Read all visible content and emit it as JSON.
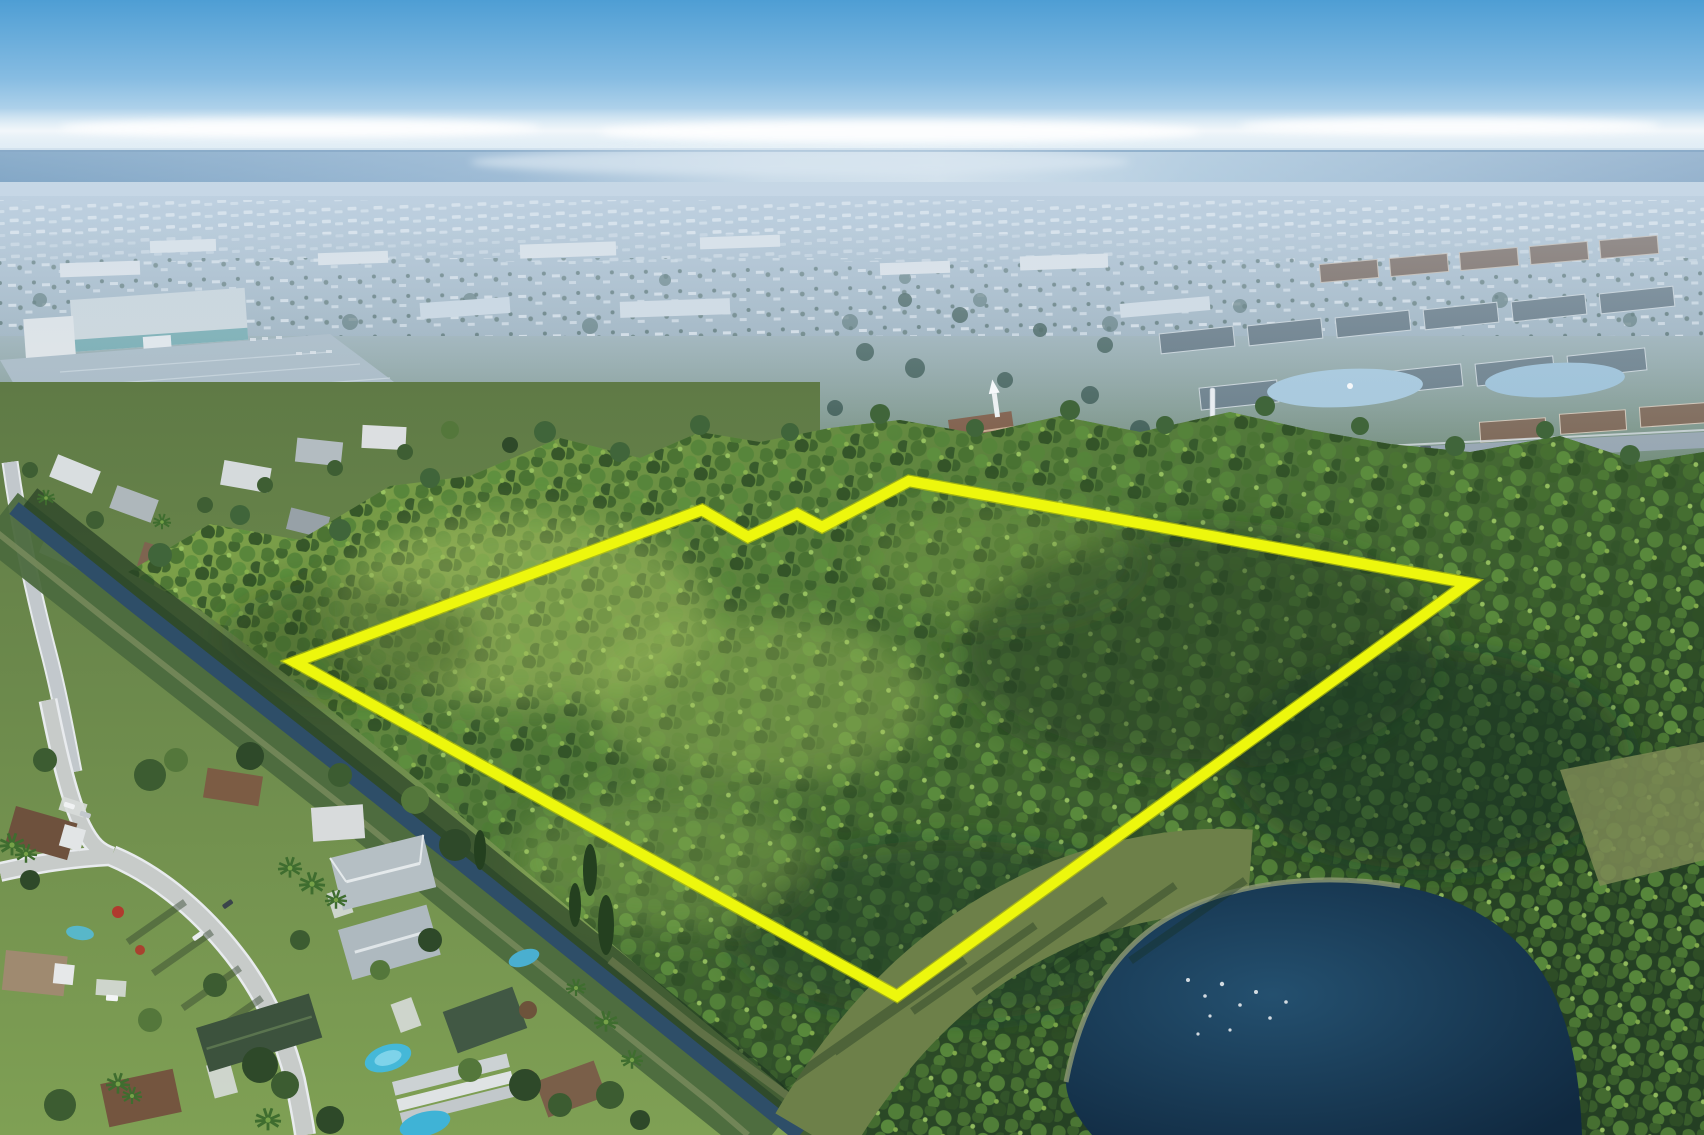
{
  "meta": {
    "title": "Aerial Property Photo",
    "description": "Aerial drone photograph of a large wooded land parcel outlined with a bright yellow property boundary. The parcel is bordered by a drainage canal and suburban single-family neighborhoods on the left, townhome communities and a church with a white steeple above, a dark retention pond at lower right, and hazy coastal urban sprawl stretching to the Atlantic Ocean on the horizon under a blue sky."
  },
  "overlay": {
    "name": "property-boundary",
    "color": "#EDF70D",
    "undercolor": "#BCC608",
    "stroke_width": 10.5,
    "under_stroke_width": 13,
    "points": "295,662 702,510 748,537 797,514 822,527 909,481 1468,583 897,996"
  },
  "palette": {
    "sky_top": "#4E9ED4",
    "sky_low": "#CBE2F0",
    "cloud": "#F2F7FA",
    "ocean_deep": "#35709F",
    "ocean_glint": "#E2ECF1",
    "haze": "#BCCFDF",
    "sprawl": "#A7BACA",
    "roof_white": "#E6EAEC",
    "road": "#C7CBC9",
    "forest_light": "#85A84C",
    "forest_dark": "#243F23",
    "canal": "#2E4E68",
    "pond_deep": "#102940",
    "lawn": "#7FA054",
    "pool": "#45B8D8"
  },
  "scene": {
    "regions": [
      {
        "name": "sky",
        "label": "clear blue sky with thin cloud band"
      },
      {
        "name": "ocean",
        "label": "ocean horizon with silvery sun glint"
      },
      {
        "name": "urban-sprawl",
        "label": "hazy coastal sprawl and mobile-home parks"
      },
      {
        "name": "mid-suburbs",
        "label": "shopping mall, strip malls, church, condos, small lake"
      },
      {
        "name": "forest-parcel",
        "label": "wooded parcel outlined in yellow"
      },
      {
        "name": "canal",
        "label": "drainage canal along the parcel's southwest edge"
      },
      {
        "name": "neighborhood",
        "label": "single-family homes, streets, pools, palms"
      },
      {
        "name": "pond",
        "label": "dark retention pond with grassy bank"
      }
    ]
  }
}
